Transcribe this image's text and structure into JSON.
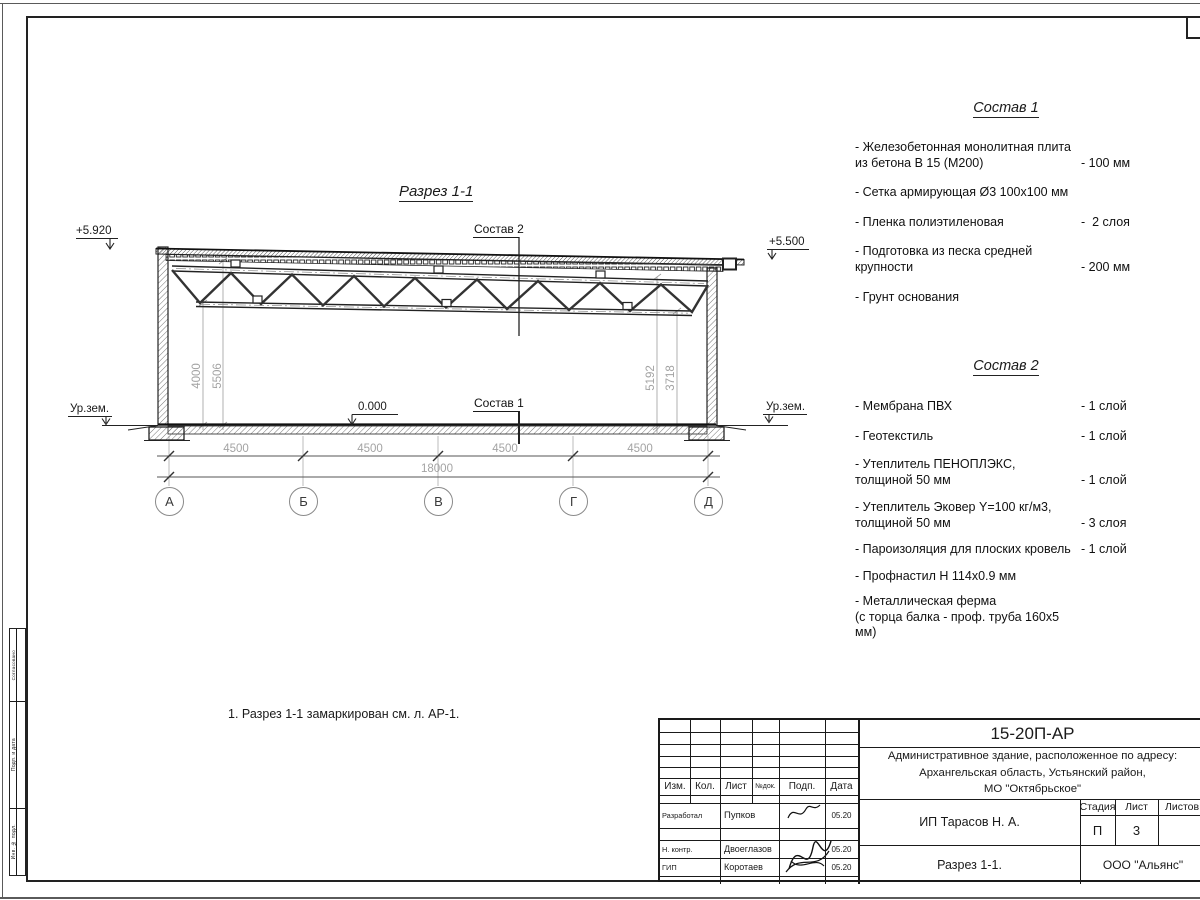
{
  "drawing": {
    "title": "Разрез 1-1",
    "elev_left": "+5.920",
    "elev_right": "+5.500",
    "ground_level_left": "Ур.зем.",
    "ground_level_right": "Ур.зем.",
    "zero_level": "0.000",
    "callout_sostav1": "Состав 1",
    "callout_sostav2": "Состав 2",
    "axes": [
      "А",
      "Б",
      "В",
      "Г",
      "Д"
    ],
    "dims_bottom": [
      "4500",
      "4500",
      "4500",
      "4500"
    ],
    "dim_total": "18000",
    "dims_left": [
      "4000",
      "5506"
    ],
    "dims_right": [
      "5192",
      "3718"
    ],
    "note": "1. Разрез 1-1 замаркирован см. л. АР-1."
  },
  "sostav1": {
    "title": "Состав 1",
    "items": [
      {
        "name": "- Железобетонная  монолитная плита\nиз бетона В 15 (М200)",
        "value": "- 100 мм"
      },
      {
        "name": "- Сетка армирующая Ø3 100х100 мм",
        "value": ""
      },
      {
        "name": "- Пленка полиэтиленовая",
        "value": "-  2 слоя"
      },
      {
        "name": "- Подготовка из песка средней\nкрупности",
        "value": "- 200 мм"
      },
      {
        "name": "- Грунт основания",
        "value": ""
      }
    ]
  },
  "sostav2": {
    "title": "Состав 2",
    "items": [
      {
        "name": "- Мембрана ПВХ",
        "value": "- 1 слой"
      },
      {
        "name": "- Геотекстиль",
        "value": "- 1 слой"
      },
      {
        "name": "- Утеплитель ПЕНОПЛЭКС,\nтолщиной 50 мм",
        "value": "- 1 слой"
      },
      {
        "name": "- Утеплитель Эковер Y=100 кг/м3,\nтолщиной 50 мм",
        "value": "- 3 слоя"
      },
      {
        "name": "- Пароизоляция для плоских кровель",
        "value": "- 1 слой"
      },
      {
        "name": "- Профнастил Н 114х0.9 мм",
        "value": ""
      },
      {
        "name": "- Металлическая ферма\n(с торца балка - проф. труба 160х5 мм)",
        "value": ""
      }
    ]
  },
  "titleblock": {
    "code": "15-20П-АР",
    "project": "Административное здание, расположенное по адресу:\nАрхангельская область, Устьянский район,\nМО \"Октябрьское\"",
    "columns": [
      "Изм.",
      "Кол.",
      "Лист",
      "№док.",
      "Подп.",
      "Дата"
    ],
    "rows": [
      {
        "role": "Разработал",
        "name": "Пупков",
        "date": "05.20"
      },
      {
        "role": "Н. контр.",
        "name": "Двоеглазов",
        "date": "05.20"
      },
      {
        "role": "ГИП",
        "name": "Коротаев",
        "date": "05.20"
      }
    ],
    "client": "ИП Тарасов Н. А.",
    "stage_label": "Стадия",
    "sheet_label": "Лист",
    "sheets_label": "Листов",
    "stage": "П",
    "sheet": "3",
    "sheet_title": "Разрез 1-1.",
    "company": "ООО \"Альянс\""
  },
  "side_stamp": {
    "cells": [
      "Согласовано",
      "Подп. и дата",
      "Инв. № подл."
    ]
  }
}
